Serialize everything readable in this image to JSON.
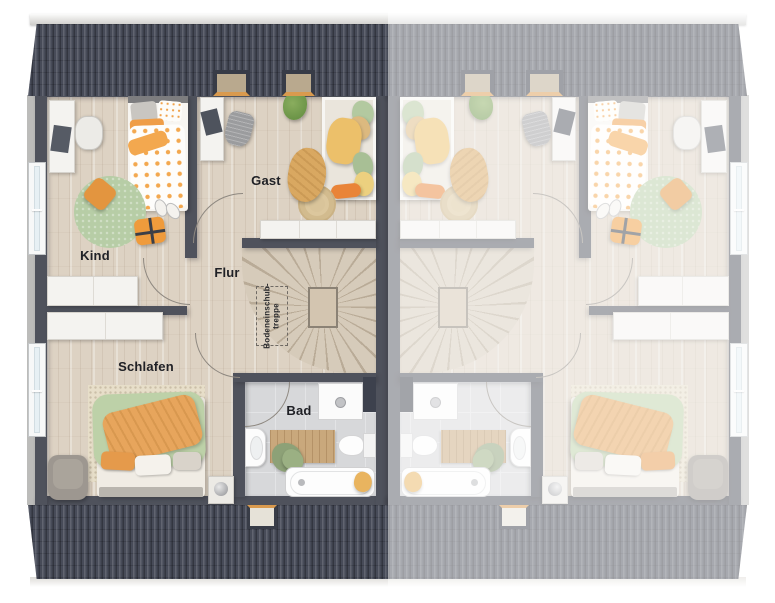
{
  "floor_plan": {
    "kind": "semi-detached-house-upper-floor",
    "left_unit_rooms": [
      "Kind",
      "Gast",
      "Flur",
      "Schlafen",
      "Bad"
    ],
    "right_unit": "mirrored copy, faded, no labels"
  },
  "labels": {
    "kind": "Kind",
    "gast": "Gast",
    "flur": "Flur",
    "schlafen": "Schlafen",
    "bad": "Bad",
    "attic_stairs_line1": "Bodeneinschub-",
    "attic_stairs_line2": "treppe"
  },
  "colors": {
    "roof": "#474b58",
    "wall": "#4f525c",
    "floor_wood": "#ddd2c3",
    "bath_tile": "#d7d8da",
    "accent_orange": "#e9a35a",
    "accent_green": "#b9cfa6",
    "label_text": "#202126",
    "mirror_fade": "rgba(255,255,255,0.52)"
  }
}
